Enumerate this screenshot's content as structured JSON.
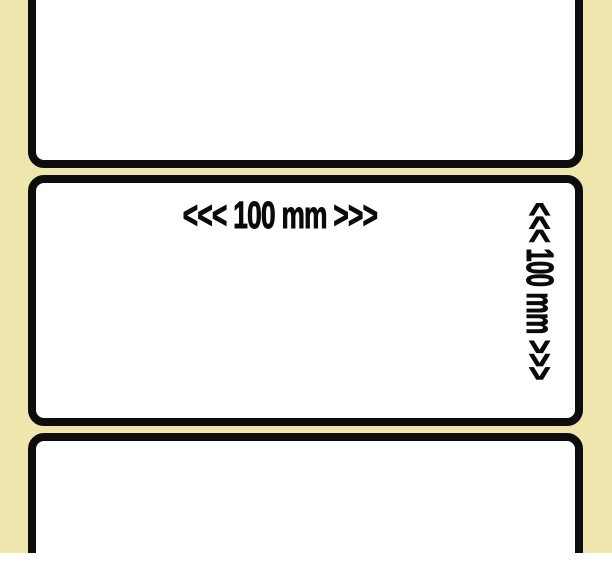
{
  "colors": {
    "canvas": "#ffffff",
    "liner": "#efe6ad",
    "label_face": "#ffffff",
    "border": "#0d0d0d"
  },
  "labels": {
    "middle": {
      "width_text": "<<< 100 mm >>>",
      "height_text": "<<< 100 mm >>>"
    }
  }
}
